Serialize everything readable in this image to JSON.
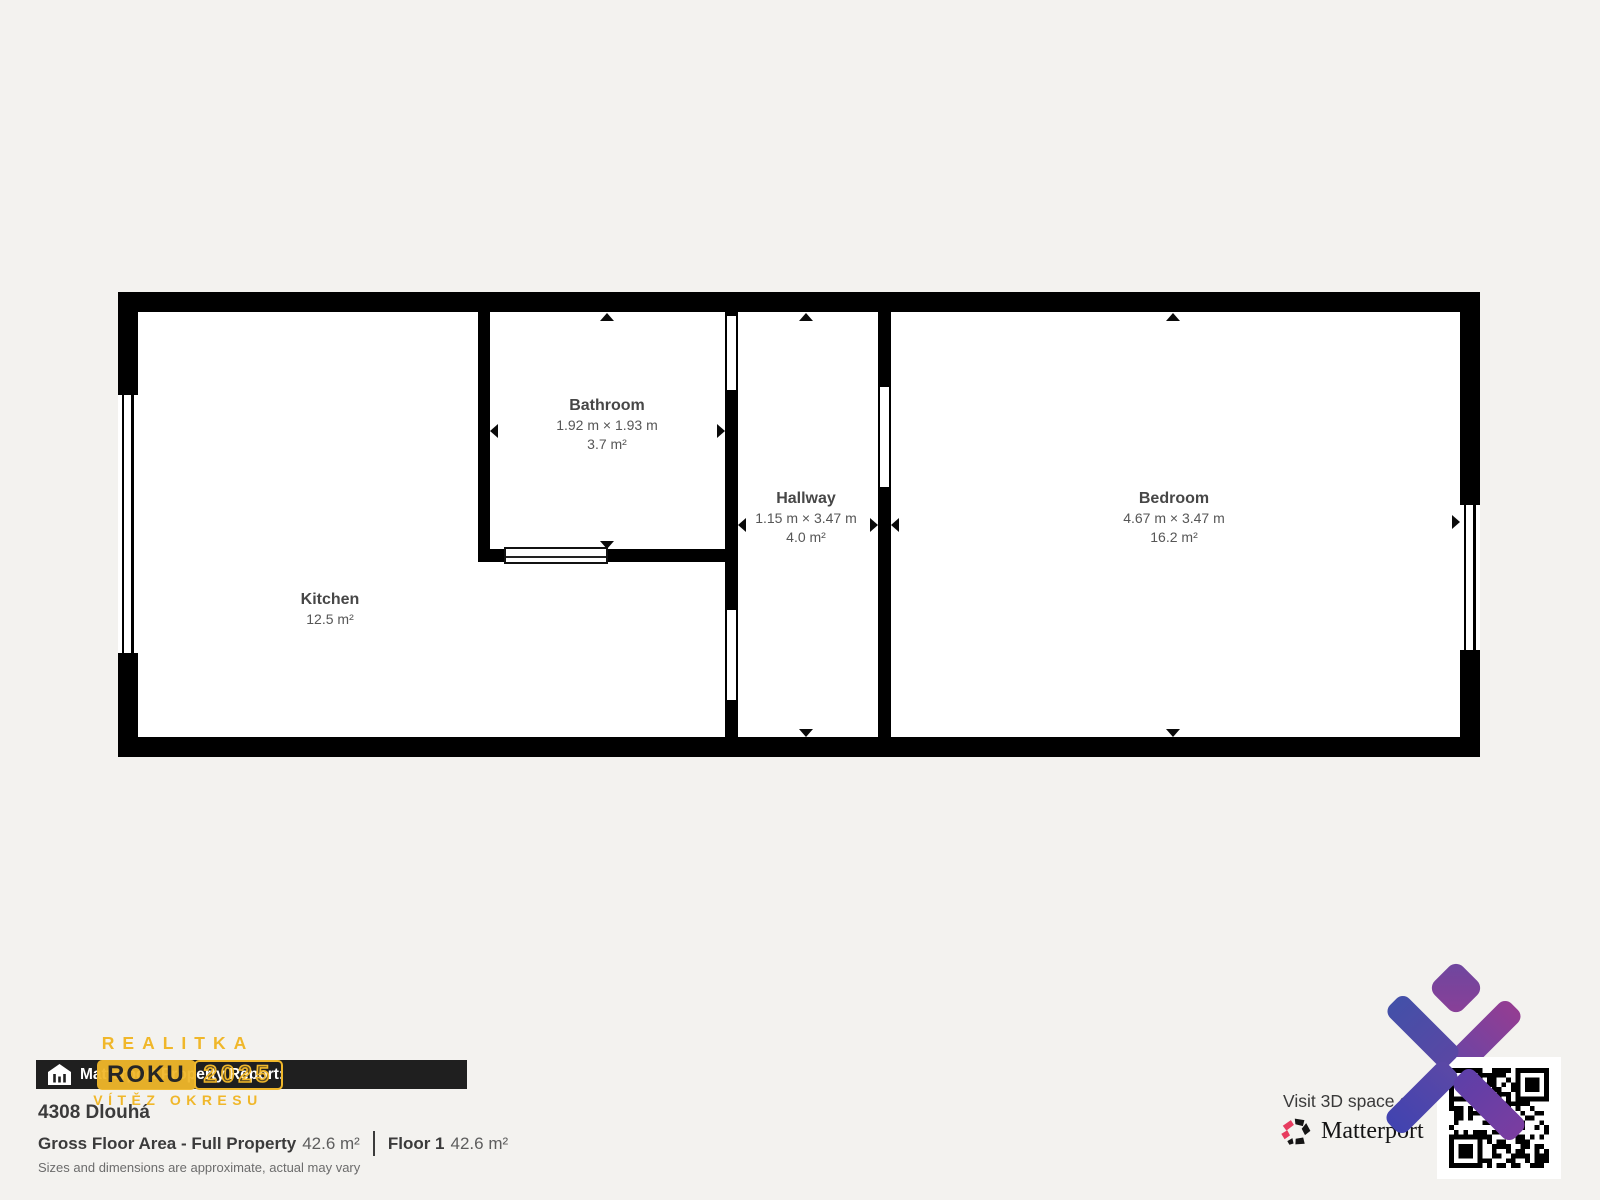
{
  "page": {
    "background": "#f3f2ef",
    "wall_color": "#000000",
    "accent_yellow": "#f0b72a",
    "logo_purple_start": "#4649a7",
    "logo_purple_end": "#8f3d96",
    "matterport_pink": "#e73c5f"
  },
  "floorplan": {
    "rooms": [
      {
        "id": "kitchen",
        "name": "Kitchen",
        "dims": "",
        "area": "12.5 m²"
      },
      {
        "id": "bathroom",
        "name": "Bathroom",
        "dims": "1.92 m × 1.93 m",
        "area": "3.7 m²"
      },
      {
        "id": "hallway",
        "name": "Hallway",
        "dims": "1.15 m × 3.47 m",
        "area": "4.0 m²"
      },
      {
        "id": "bedroom",
        "name": "Bedroom",
        "dims": "4.67 m × 3.47 m",
        "area": "16.2 m²"
      }
    ],
    "icons": [
      "dimension-arrow-up",
      "dimension-arrow-down",
      "dimension-arrow-left",
      "dimension-arrow-right",
      "window-symbol",
      "sliding-door-symbol",
      "door-opening-symbol"
    ]
  },
  "report": {
    "bar_label": "Matterport Property Report:",
    "bar_icon": "house-chart-icon",
    "address": "4308 Dlouhá",
    "gross_label": "Gross Floor Area - Full Property",
    "gross_value": "42.6 m²",
    "floor_label": "Floor 1",
    "floor_value": "42.6 m²",
    "disclaimer": "Sizes and dimensions are approximate, actual may vary"
  },
  "badge": {
    "line1": "REALITKA",
    "line2_left": "ROKU",
    "line2_right": "2025",
    "line3": "VÍTĚZ OKRESU"
  },
  "footer_right": {
    "visit_text": "Visit 3D space o",
    "brand": "Matterport",
    "brand_icon": "matterport-pinwheel-icon",
    "qr_icon": "qr-code",
    "watermark_icon": "purple-x-diamond-logo"
  }
}
